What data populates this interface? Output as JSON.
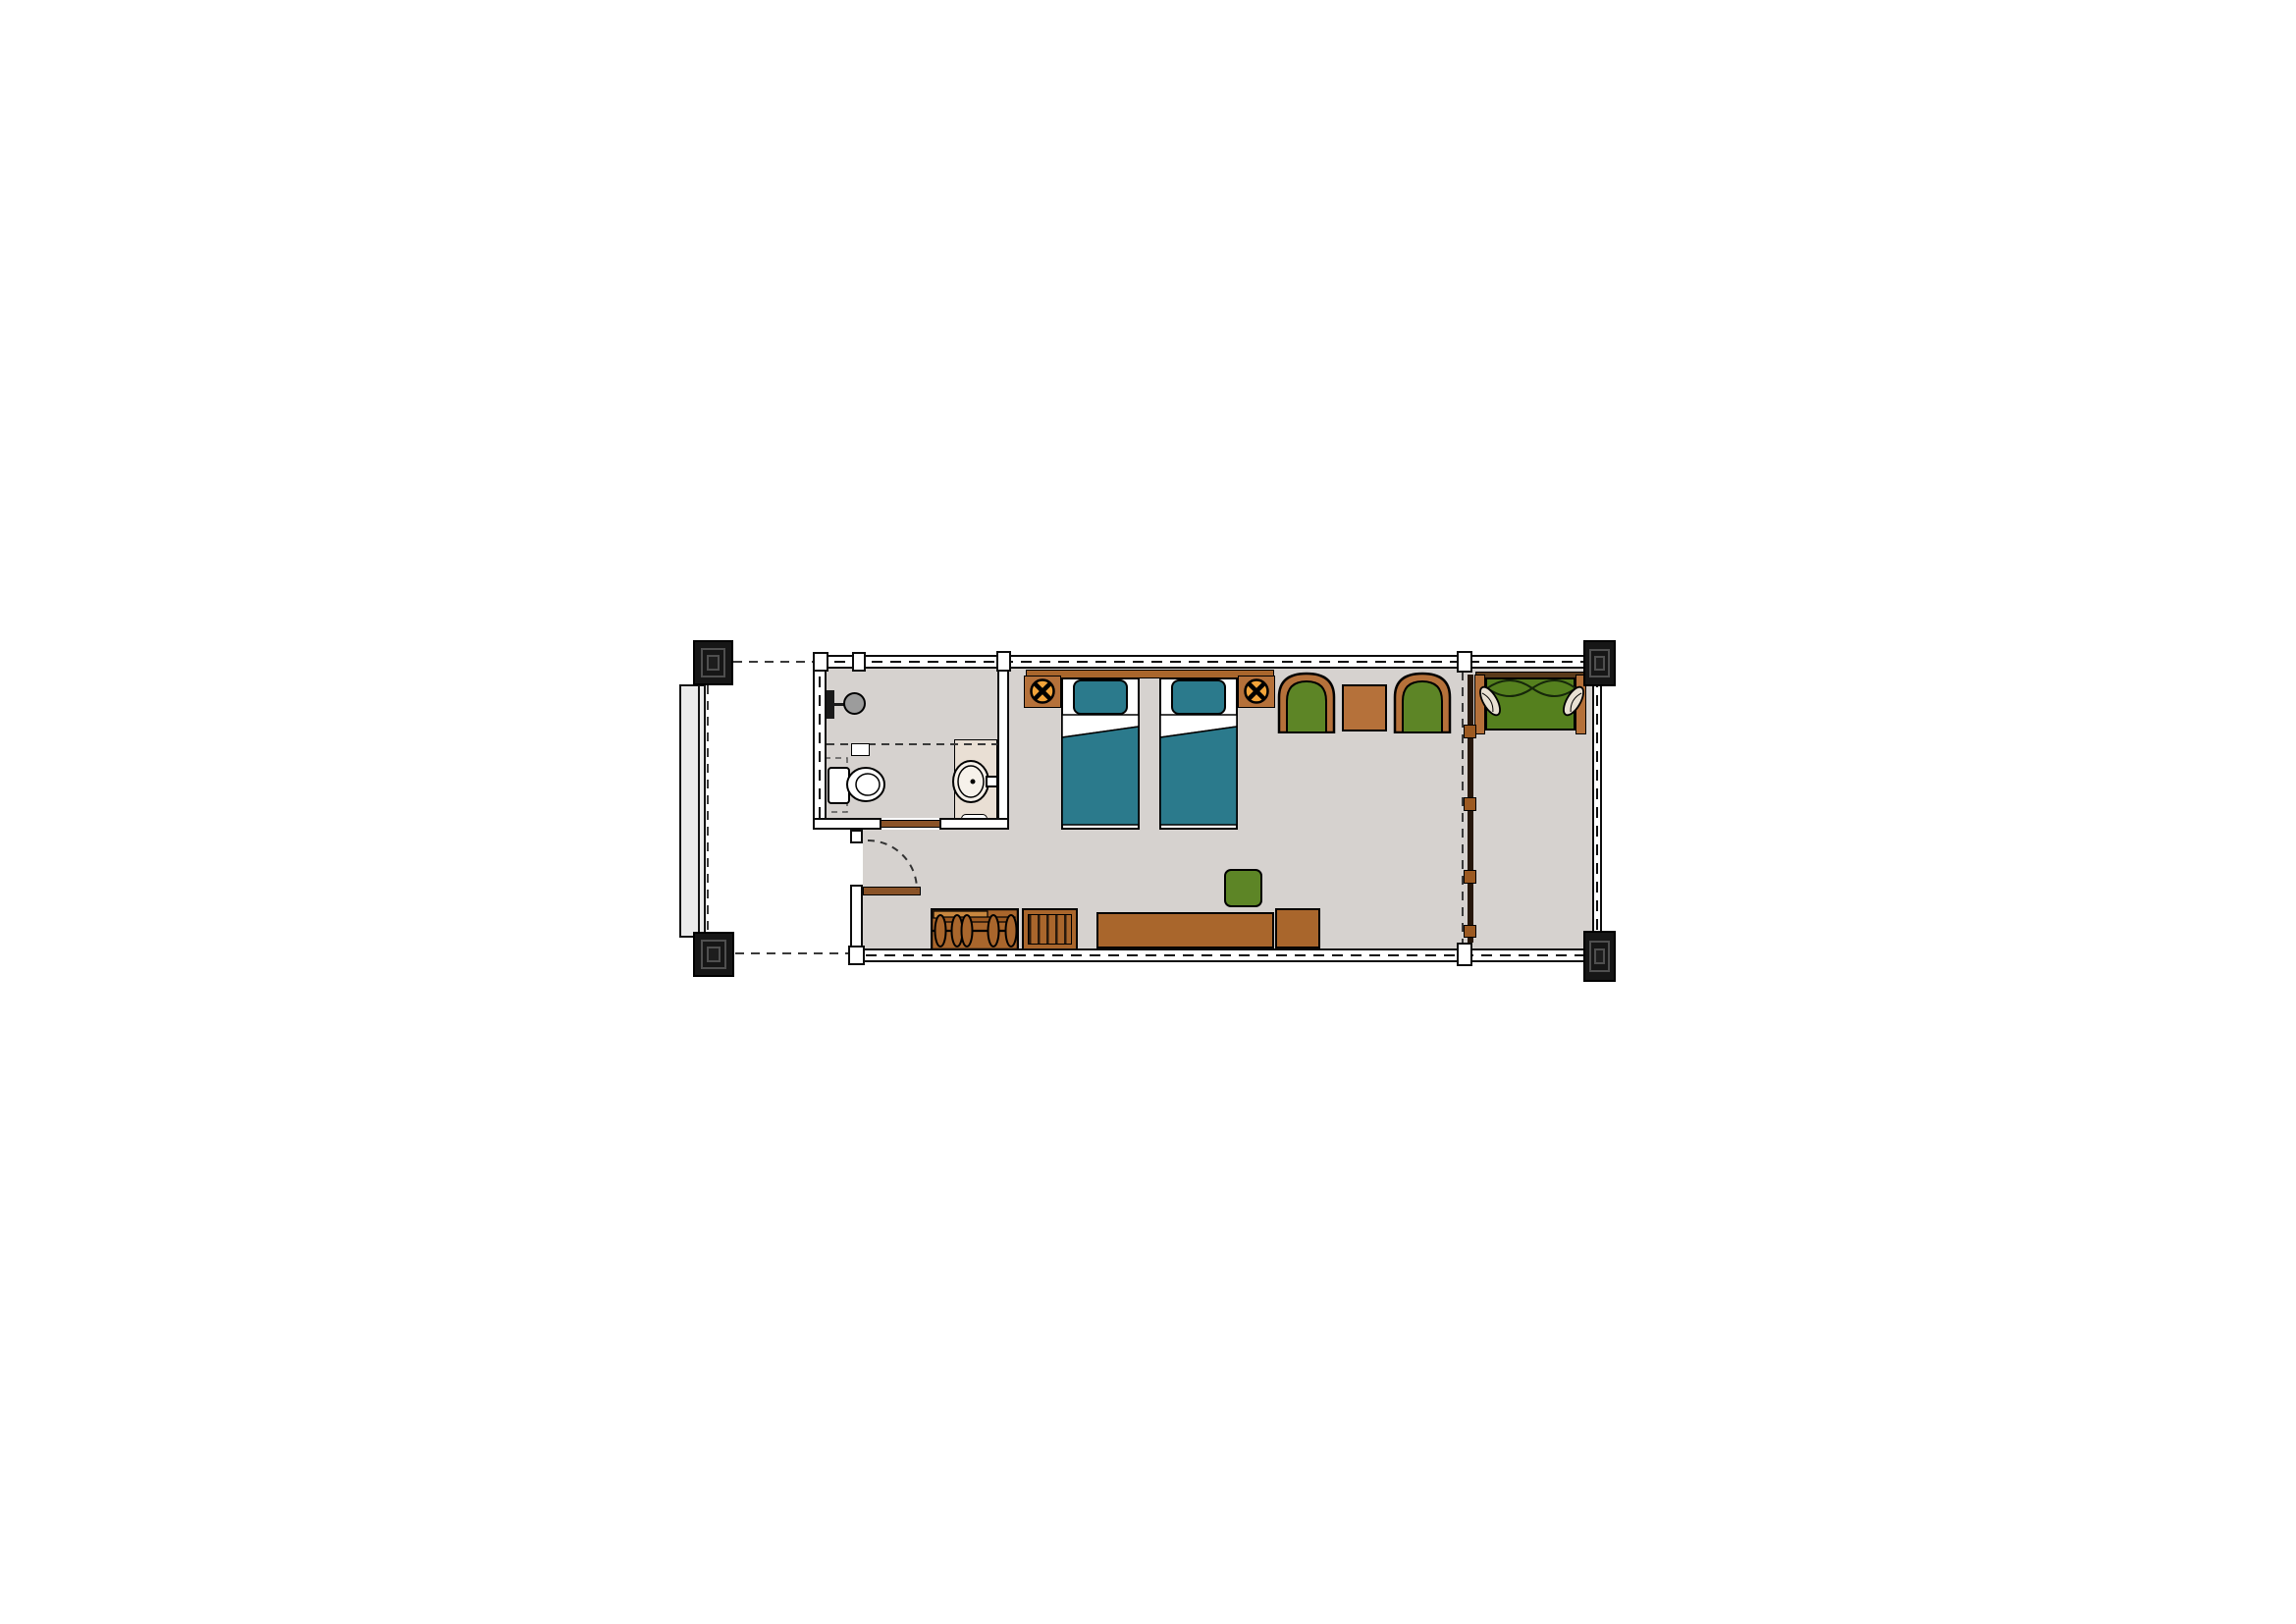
{
  "page": {
    "type": "architectural-floor-plan",
    "subject": "hotel guest room with twin beds, bathroom and sitting alcove",
    "visible_text": [],
    "background": "#ffffff"
  },
  "palette": {
    "ink": "#0d0d0d",
    "wall_fill": "#ffffff",
    "floor": "#d6d2cf",
    "floor_light": "#ececec",
    "beige": "#e9dfd4",
    "teal": "#2b7a8c",
    "green": "#5d8526",
    "green_dark": "#55801e",
    "wood": "#a9662c",
    "wood_light": "#b5713a",
    "wood_lighter": "#c8873f",
    "wood_dark": "#8a5328",
    "wood_deep": "#5a3a1a",
    "panel_dark": "#26170c",
    "lamp_orange": "#f2a43a",
    "fixture_gray": "#9c9c9c",
    "cream": "#e8e0d2",
    "column_fill": "#161616",
    "column_bevel": "#4f4f4f",
    "dash_line": "#3a3a3a"
  },
  "plan": {
    "rooms": [
      {
        "name": "bathroom"
      },
      {
        "name": "bedroom"
      },
      {
        "name": "sitting-alcove"
      },
      {
        "name": "entry-vestibule"
      },
      {
        "name": "access-walkway"
      }
    ],
    "structure": [
      {
        "name": "structural-column",
        "count": 4
      },
      {
        "name": "exterior-wall-with-dashed-centerline"
      },
      {
        "name": "sliding-partition-with-four-panels"
      },
      {
        "name": "entry-swing-door"
      },
      {
        "name": "bathroom-sliding-door"
      }
    ],
    "furniture": [
      {
        "name": "twin-bed",
        "count": 2,
        "color_key": "teal"
      },
      {
        "name": "headboard",
        "color_key": "wood"
      },
      {
        "name": "nightstand-with-lamp",
        "count": 2,
        "color_key": "wood"
      },
      {
        "name": "armchair",
        "count": 2,
        "color_key": "green"
      },
      {
        "name": "side-table",
        "color_key": "wood_light"
      },
      {
        "name": "daybed-with-pillows",
        "color_key": "green_dark"
      },
      {
        "name": "desk-console",
        "color_key": "wood"
      },
      {
        "name": "stool",
        "color_key": "green"
      },
      {
        "name": "minibar-cabinet",
        "color_key": "wood"
      },
      {
        "name": "luggage-rack",
        "color_key": "wood"
      }
    ],
    "fixtures": [
      {
        "name": "toilet"
      },
      {
        "name": "vanity-sink"
      },
      {
        "name": "shower-head"
      },
      {
        "name": "amenity-tray"
      }
    ]
  }
}
